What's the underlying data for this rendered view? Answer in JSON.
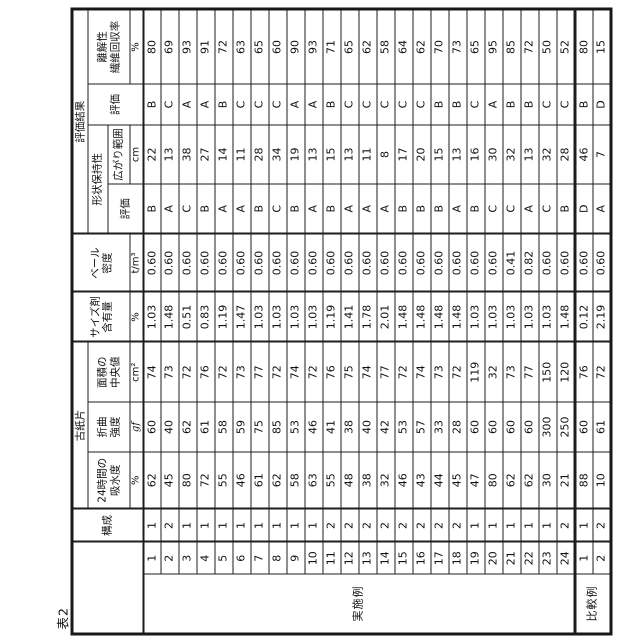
{
  "title": "表2",
  "table": {
    "header": {
      "kousei": "構成",
      "koshihen_group": "古紙片",
      "absorb_l1": "24時間の",
      "absorb_l2": "吸水度",
      "absorb_unit": "%",
      "bend_l1": "折曲",
      "bend_l2": "強度",
      "bend_unit": "gf",
      "area_l1": "面積の",
      "area_l2": "中央値",
      "area_unit": "cm²",
      "size_l1": "サイズ剤",
      "size_l2": "含有量",
      "size_unit": "%",
      "bale_l1": "ベール",
      "bale_l2": "密度",
      "bale_unit": "t/m³",
      "eval_group": "評価結果",
      "shape_group": "形状保持性",
      "shape_eval": "評価",
      "spread": "広がり範囲",
      "spread_unit": "cm",
      "overall_eval": "評価",
      "disint_l1": "離解性",
      "disint_l2": "繊維回収率",
      "disint_unit": "%"
    },
    "columns": [
      "番号",
      "構成",
      "24時間の吸水度 %",
      "折曲強度 gf",
      "面積の中央値 cm²",
      "サイズ剤含有量 %",
      "ベール密度 t/m³",
      "形状保持性 評価",
      "広がり範囲 cm",
      "評価",
      "離解性 繊維回収率 %"
    ],
    "groups": [
      {
        "label": "実施例",
        "rows": [
          [
            "1",
            "1",
            "62",
            "60",
            "74",
            "1.03",
            "0.60",
            "B",
            "22",
            "B",
            "80"
          ],
          [
            "2",
            "2",
            "45",
            "40",
            "73",
            "1.48",
            "0.60",
            "A",
            "13",
            "C",
            "69"
          ],
          [
            "3",
            "1",
            "80",
            "62",
            "72",
            "0.51",
            "0.60",
            "C",
            "38",
            "A",
            "93"
          ],
          [
            "4",
            "1",
            "72",
            "61",
            "76",
            "0.83",
            "0.60",
            "B",
            "27",
            "A",
            "91"
          ],
          [
            "5",
            "1",
            "55",
            "58",
            "72",
            "1.19",
            "0.60",
            "A",
            "14",
            "B",
            "72"
          ],
          [
            "6",
            "1",
            "46",
            "59",
            "73",
            "1.47",
            "0.60",
            "A",
            "11",
            "C",
            "63"
          ],
          [
            "7",
            "1",
            "61",
            "75",
            "77",
            "1.03",
            "0.60",
            "B",
            "28",
            "C",
            "65"
          ],
          [
            "8",
            "1",
            "62",
            "85",
            "72",
            "1.03",
            "0.60",
            "C",
            "34",
            "C",
            "60"
          ],
          [
            "9",
            "1",
            "58",
            "53",
            "74",
            "1.03",
            "0.60",
            "B",
            "19",
            "A",
            "90"
          ],
          [
            "10",
            "1",
            "63",
            "46",
            "72",
            "1.03",
            "0.60",
            "A",
            "13",
            "A",
            "93"
          ],
          [
            "11",
            "2",
            "55",
            "41",
            "76",
            "1.19",
            "0.60",
            "B",
            "15",
            "B",
            "71"
          ],
          [
            "12",
            "2",
            "48",
            "38",
            "75",
            "1.41",
            "0.60",
            "A",
            "13",
            "C",
            "65"
          ],
          [
            "13",
            "2",
            "38",
            "40",
            "74",
            "1.78",
            "0.60",
            "A",
            "11",
            "C",
            "62"
          ],
          [
            "14",
            "2",
            "32",
            "42",
            "77",
            "2.01",
            "0.60",
            "A",
            "8",
            "C",
            "58"
          ],
          [
            "15",
            "2",
            "46",
            "53",
            "72",
            "1.48",
            "0.60",
            "B",
            "17",
            "C",
            "64"
          ],
          [
            "16",
            "2",
            "43",
            "57",
            "74",
            "1.48",
            "0.60",
            "B",
            "20",
            "C",
            "62"
          ],
          [
            "17",
            "2",
            "44",
            "33",
            "73",
            "1.48",
            "0.60",
            "B",
            "15",
            "B",
            "70"
          ],
          [
            "18",
            "2",
            "45",
            "28",
            "72",
            "1.48",
            "0.60",
            "A",
            "13",
            "B",
            "73"
          ],
          [
            "19",
            "1",
            "47",
            "60",
            "119",
            "1.03",
            "0.60",
            "B",
            "16",
            "C",
            "65"
          ],
          [
            "20",
            "1",
            "80",
            "60",
            "32",
            "1.03",
            "0.60",
            "C",
            "30",
            "A",
            "95"
          ],
          [
            "21",
            "1",
            "62",
            "60",
            "73",
            "1.03",
            "0.41",
            "C",
            "32",
            "B",
            "85"
          ],
          [
            "22",
            "1",
            "62",
            "60",
            "77",
            "1.03",
            "0.82",
            "A",
            "13",
            "B",
            "72"
          ],
          [
            "23",
            "1",
            "30",
            "300",
            "150",
            "1.03",
            "0.60",
            "C",
            "32",
            "C",
            "50"
          ],
          [
            "24",
            "2",
            "21",
            "250",
            "120",
            "1.48",
            "0.60",
            "B",
            "28",
            "C",
            "52"
          ]
        ]
      },
      {
        "label": "比較例",
        "rows": [
          [
            "1",
            "1",
            "88",
            "60",
            "76",
            "0.12",
            "0.60",
            "D",
            "46",
            "B",
            "80"
          ],
          [
            "2",
            "2",
            "10",
            "61",
            "72",
            "2.19",
            "0.60",
            "A",
            "7",
            "D",
            "15"
          ]
        ]
      }
    ]
  }
}
